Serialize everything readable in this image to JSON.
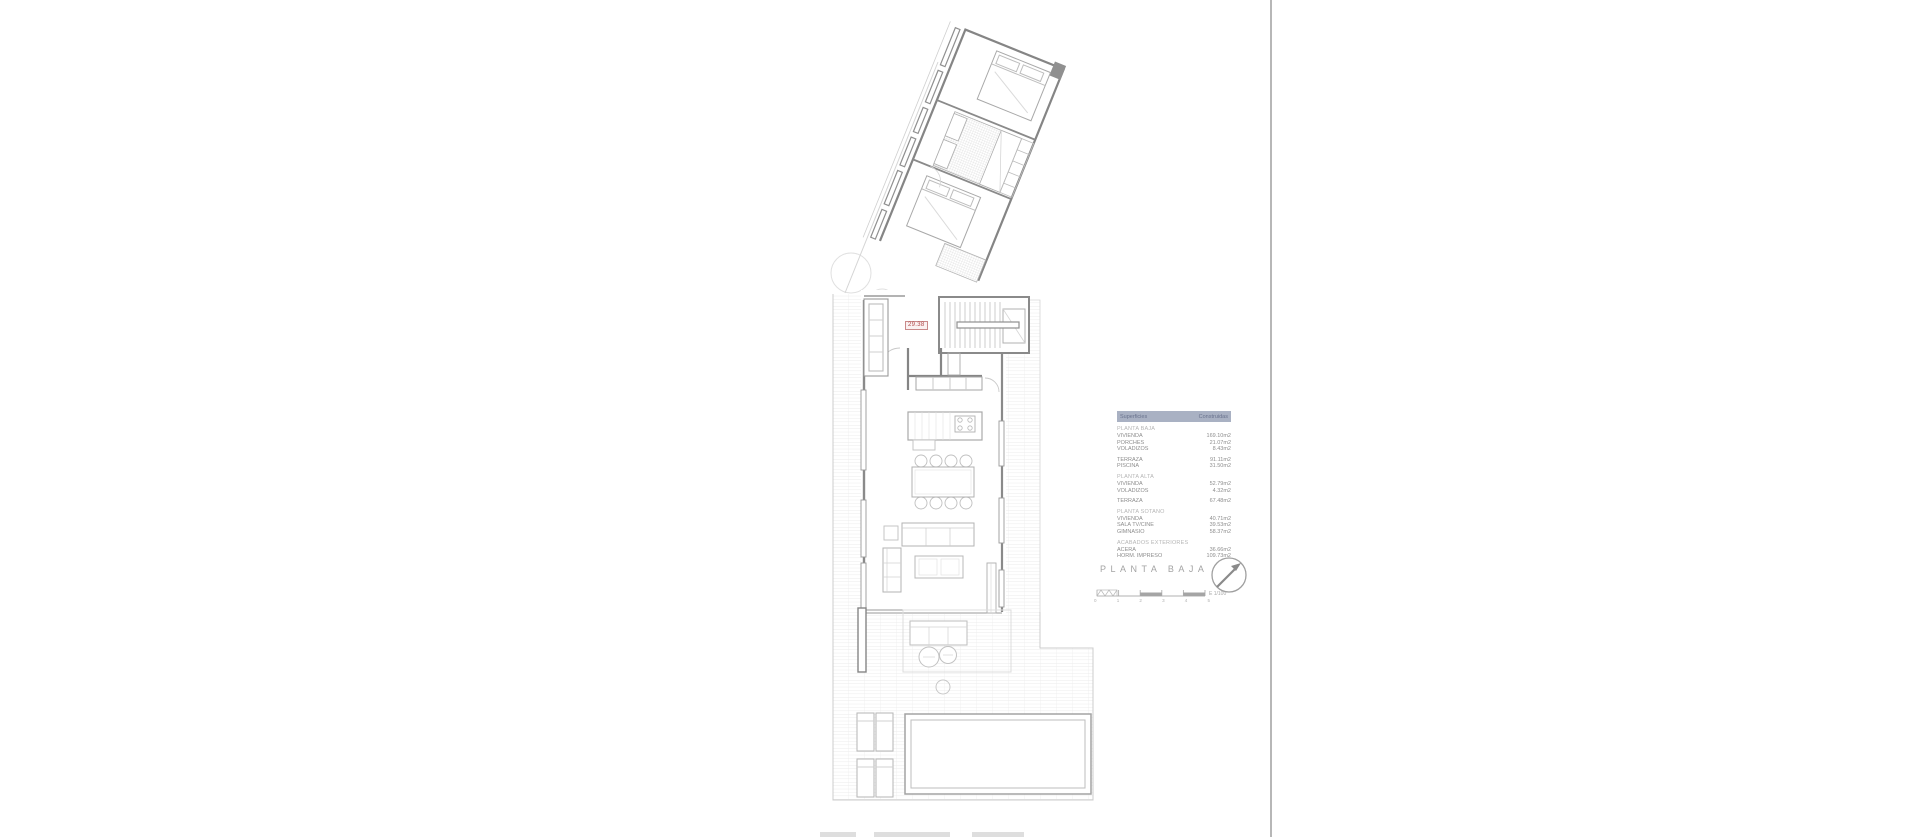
{
  "plan": {
    "title": "PLANTA BAJA",
    "scale_label": "E 1/100",
    "scale_ticks": [
      "0",
      "1",
      "2",
      "3",
      "4",
      "5"
    ],
    "level_label": "29.38",
    "accent_red": "#b04848",
    "line_gray": "#8a8a8a"
  },
  "legend": {
    "header": {
      "left": "Superficies",
      "right": "Construidas",
      "bg": "#a9b1c3"
    },
    "sections": [
      {
        "title": "PLANTA BAJA",
        "rows": [
          {
            "label": "VIVIENDA",
            "value": "169.10m2"
          },
          {
            "label": "PORCHES",
            "value": "21.07m2"
          },
          {
            "label": "VOLADIZOS",
            "value": "8.43m2"
          }
        ]
      },
      {
        "title": "",
        "rows": [
          {
            "label": "TERRAZA",
            "value": "91.11m2"
          },
          {
            "label": "PISCINA",
            "value": "31.50m2"
          }
        ]
      },
      {
        "title": "PLANTA ALTA",
        "rows": [
          {
            "label": "VIVIENDA",
            "value": "52.79m2"
          },
          {
            "label": "VOLADIZOS",
            "value": "4.32m2"
          }
        ]
      },
      {
        "title": "",
        "rows": [
          {
            "label": "TERRAZA",
            "value": "67.48m2"
          }
        ]
      },
      {
        "title": "PLANTA SOTANO",
        "rows": [
          {
            "label": "VIVIENDA",
            "value": "40.71m2"
          },
          {
            "label": "SALA TV/CINE",
            "value": "39.53m2"
          },
          {
            "label": "GIMNASIO",
            "value": "58.37m2"
          }
        ]
      },
      {
        "title": "ACABADOS EXTERIORES",
        "rows": [
          {
            "label": "ACERA",
            "value": "36.66m2"
          },
          {
            "label": "HORM. IMPRESO",
            "value": "109.73m2"
          }
        ]
      }
    ]
  }
}
